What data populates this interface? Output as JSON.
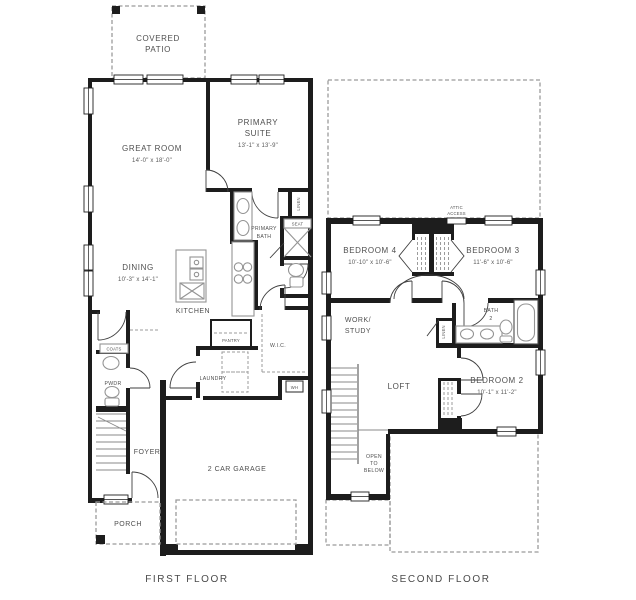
{
  "colors": {
    "walls": "#1d1d1d",
    "text": "#4f4f4f",
    "fixtures": "#949494",
    "dashed_lines": "#9b9b9b",
    "background": "#ffffff"
  },
  "first_floor": {
    "caption": "FIRST FLOOR",
    "covered_patio": {
      "line1": "COVERED",
      "line2": "PATIO"
    },
    "great_room": {
      "name": "GREAT ROOM",
      "dims": "14'-0\" x 18'-0\""
    },
    "primary_suite": {
      "line1": "PRIMARY",
      "line2": "SUITE",
      "dims": "13'-1\" x 13'-9\""
    },
    "primary_bath": {
      "line1": "PRIMARY",
      "line2": "BATH"
    },
    "dining": {
      "name": "DINING",
      "dims": "10'-3\" x 14'-1\""
    },
    "kitchen": {
      "name": "KITCHEN"
    },
    "pantry": {
      "name": "PANTRY"
    },
    "wic": {
      "name": "W.I.C."
    },
    "laundry": {
      "name": "LAUNDRY"
    },
    "coats": {
      "name": "COATS"
    },
    "powder": {
      "name": "PWDR"
    },
    "foyer": {
      "name": "FOYER"
    },
    "porch": {
      "name": "PORCH"
    },
    "garage": {
      "name": "2 CAR GARAGE"
    },
    "linen": {
      "name": "LINEN"
    },
    "seat": {
      "name": "SEAT"
    },
    "water_heater": {
      "name": "WH"
    }
  },
  "second_floor": {
    "caption": "SECOND FLOOR",
    "attic_access": {
      "line1": "ATTIC",
      "line2": "ACCESS"
    },
    "bedroom4": {
      "name": "BEDROOM 4",
      "dims": "10'-10\" x 10'-6\""
    },
    "bedroom3": {
      "name": "BEDROOM 3",
      "dims": "11'-6\" x 10'-6\""
    },
    "work_study": {
      "line1": "WORK/",
      "line2": "STUDY"
    },
    "bath2": {
      "line1": "BATH",
      "line2": "2"
    },
    "linen": {
      "name": "LINEN"
    },
    "loft": {
      "name": "LOFT"
    },
    "bedroom2": {
      "name": "BEDROOM 2",
      "dims": "10'-1\" x 11'-2\""
    },
    "open_to_below": {
      "line1": "OPEN",
      "line2": "TO",
      "line3": "BELOW"
    }
  }
}
